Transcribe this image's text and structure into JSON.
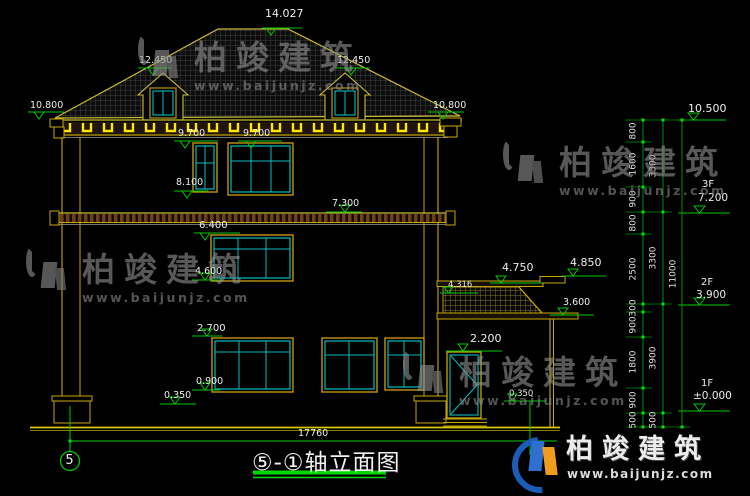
{
  "title": {
    "text": "⑤-①轴立面图"
  },
  "axis": {
    "bubble": "5"
  },
  "dims": {
    "total_width": "17760",
    "col1": [
      "800",
      "1600",
      "900",
      "800",
      "2500",
      "300",
      "900",
      "1800",
      "900",
      "500"
    ],
    "col2": [
      "3300",
      "3300",
      "3900",
      "500"
    ],
    "col3": [
      "11000"
    ]
  },
  "levels": {
    "apex": "14.027",
    "dormer_left": "12.450",
    "dormer_right": "12.450",
    "eave_left": "10.800",
    "eave_right": "10.800",
    "win3_head_left": "9.700",
    "win3_head_right": "9.700",
    "win3_sill": "8.100",
    "band": "7.300",
    "win2_head": "6.400",
    "win2_sill": "4.600",
    "win1_head": "2.700",
    "win1_sill": "0.900",
    "plinth_left": "0.350",
    "plinth_right": "0.350",
    "door_head": "2.200",
    "rail_top": "4.750",
    "post_cap": "4.850",
    "rail_mid": "4.316",
    "porch_slab": "3.600",
    "top_right": "10.500"
  },
  "floors": [
    {
      "label": "3F",
      "elevation": "7.200"
    },
    {
      "label": "2F",
      "elevation": "3.900"
    },
    {
      "label": "1F",
      "elevation": "±0.000"
    }
  ],
  "watermark": {
    "brand": "柏竣建筑",
    "url": "www.baijunjz.com"
  },
  "logo": {
    "brand": "柏竣建筑",
    "url": "www.baijunjz.com"
  },
  "colors": {
    "line_yellow": "#d2b800",
    "highlight_yellow": "#ffe800",
    "sash_cyan": "#00bdbd",
    "dim_green": "#00c800",
    "text_white": "#ededed",
    "background": "#000000"
  }
}
